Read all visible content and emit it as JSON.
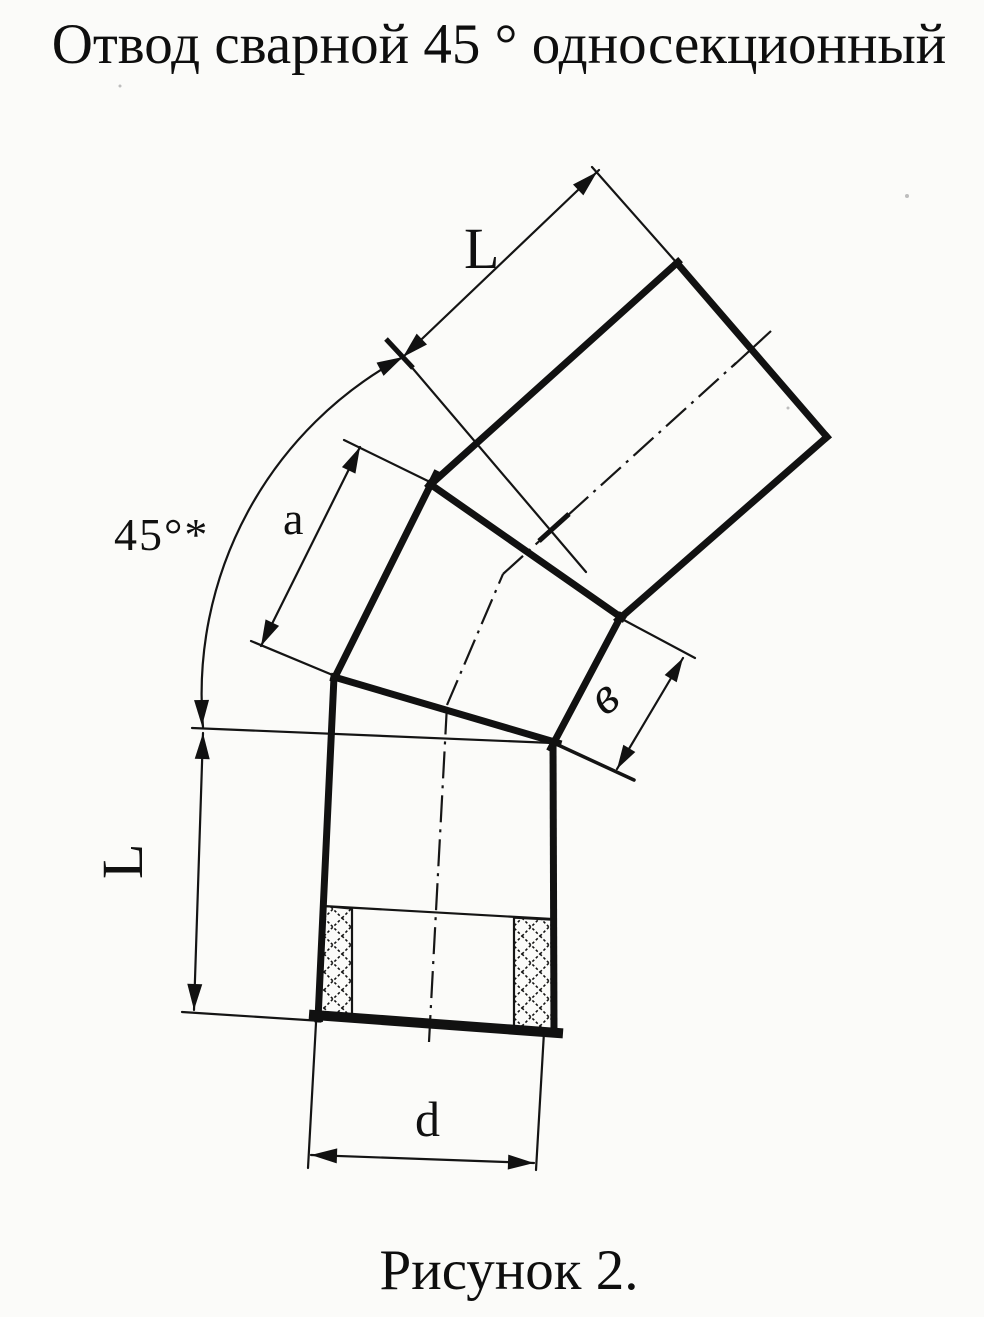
{
  "title": "Отвод сварной 45 ° односекционный",
  "caption": "Рисунок 2.",
  "dimensions": {
    "top_length": "L",
    "left_length": "L",
    "angle": "45°*",
    "section_edge": "a",
    "section_end_width": "в",
    "diameter": "d"
  },
  "colors": {
    "ink": "#141414",
    "paper": "#fbfbf9"
  }
}
